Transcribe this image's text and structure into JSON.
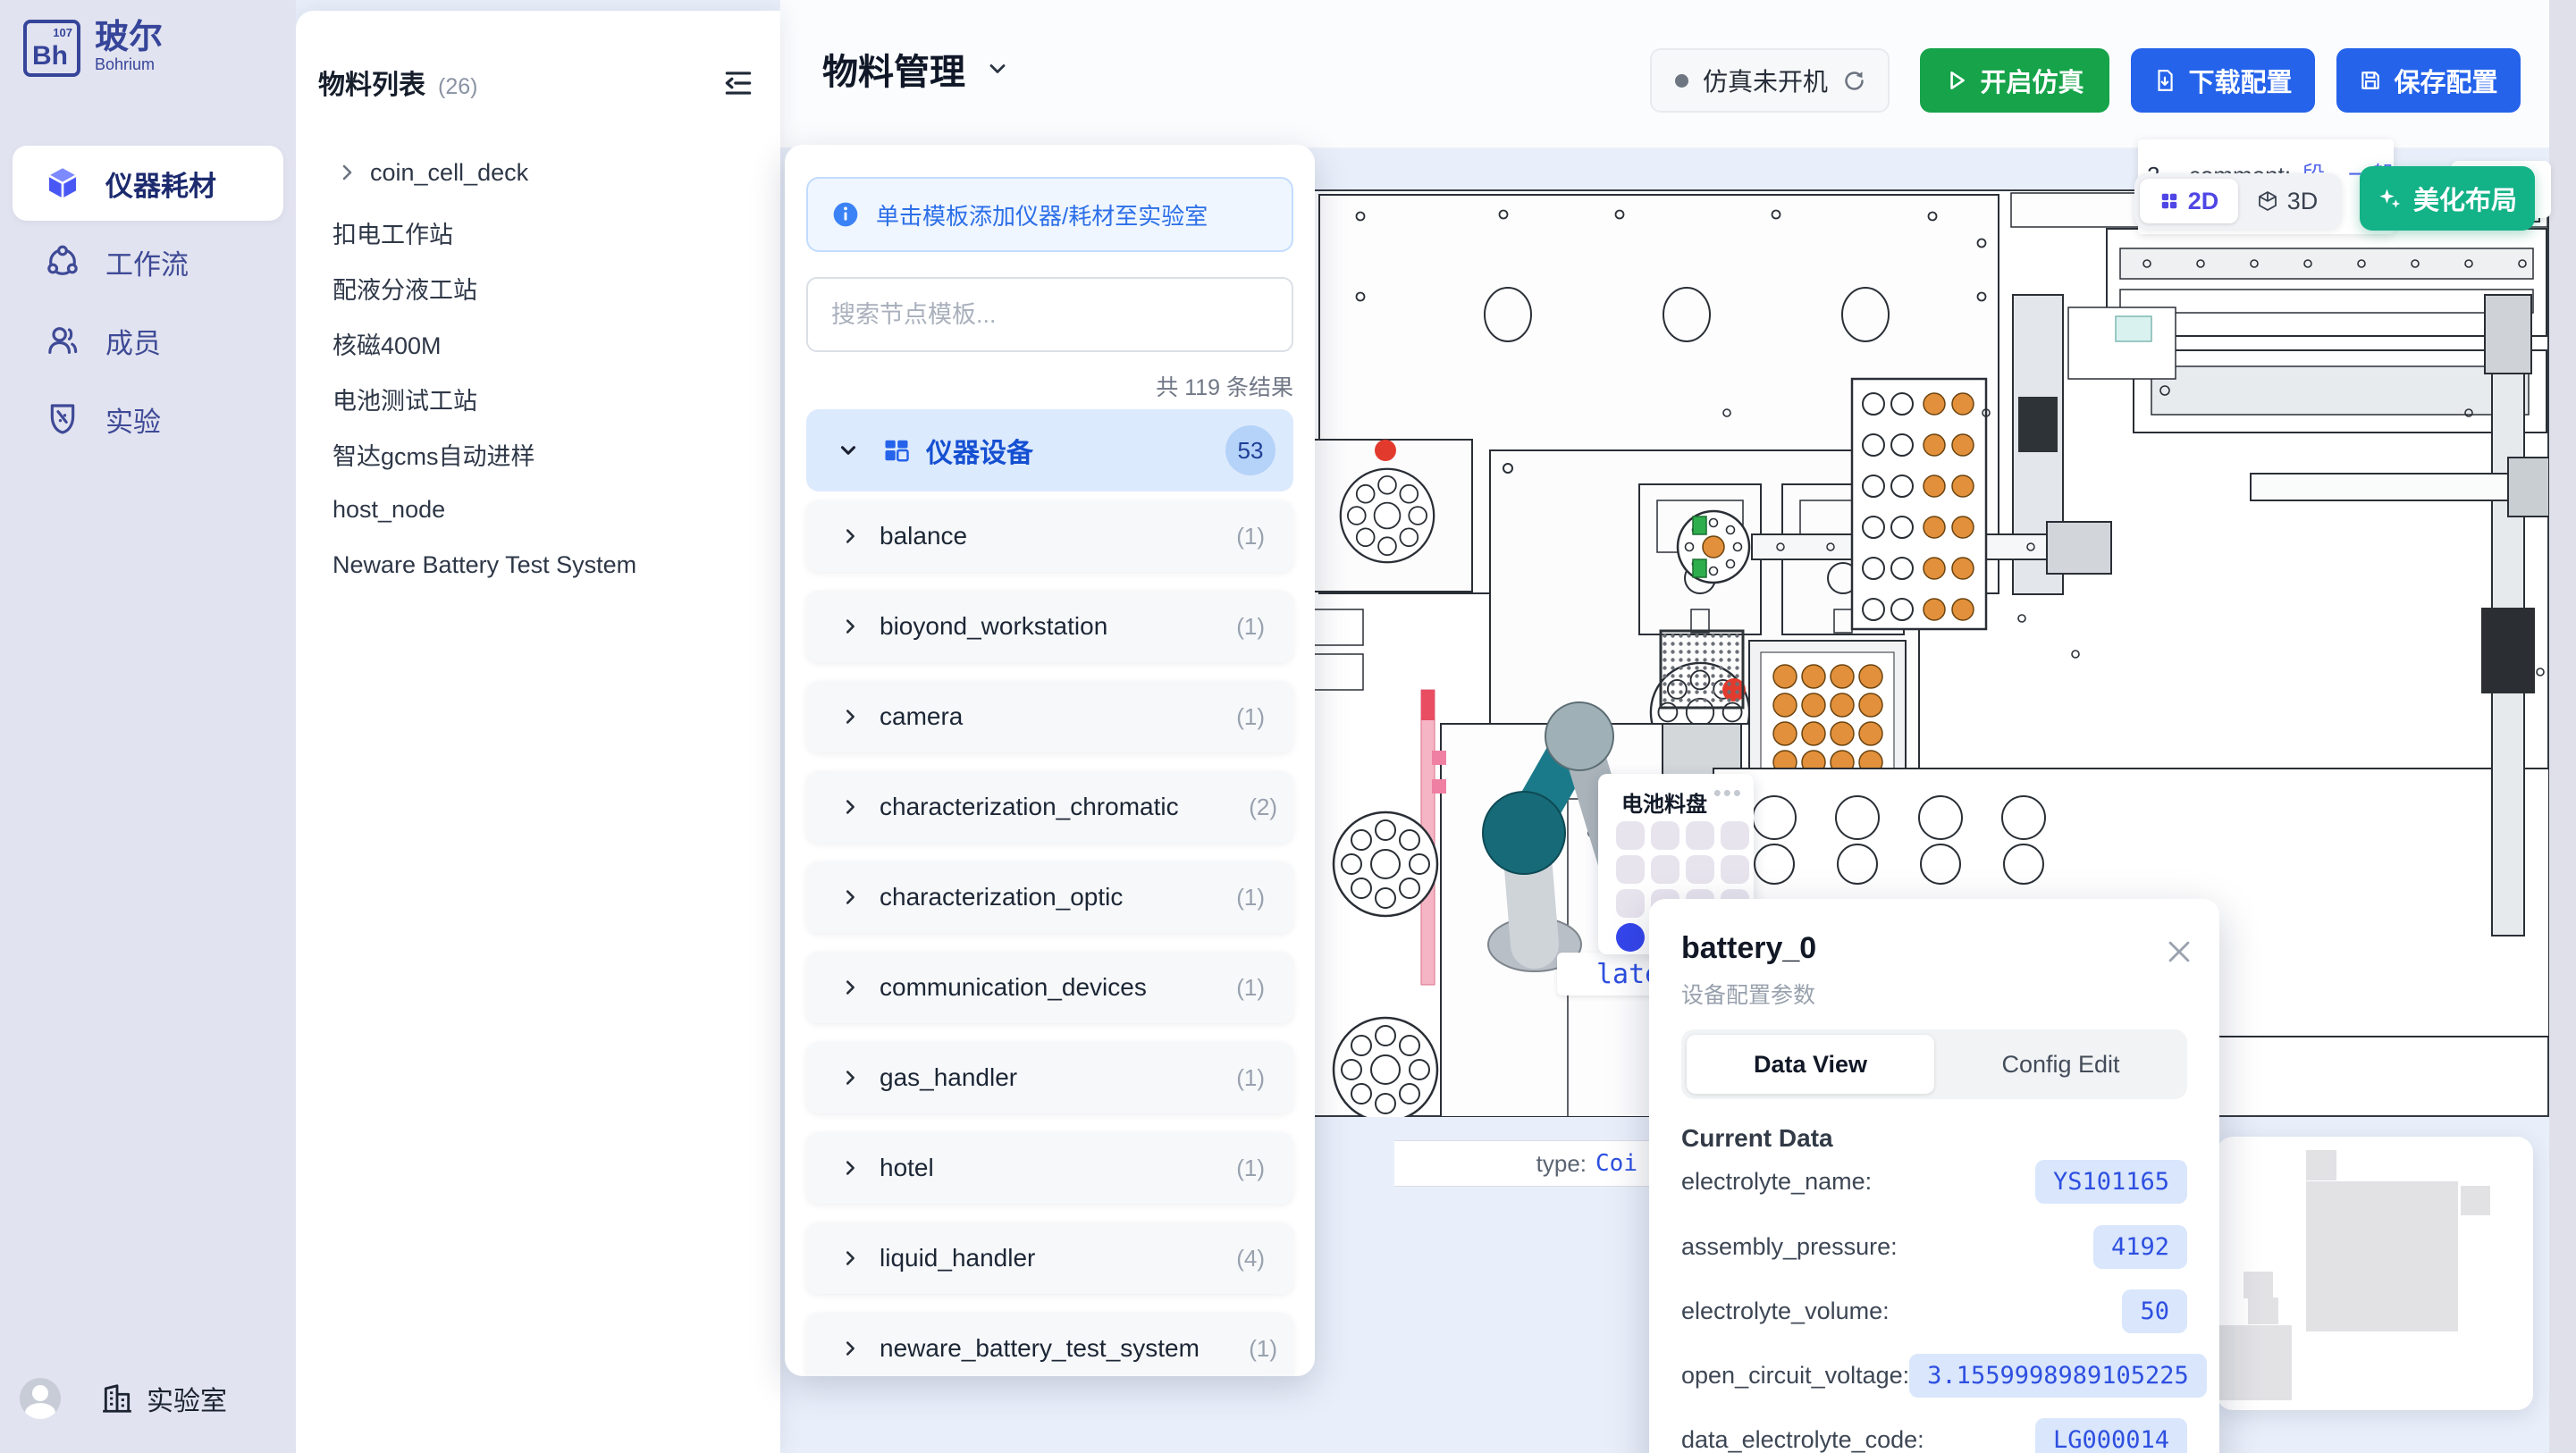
{
  "sidebar": {
    "logo": {
      "abbr": "Bh",
      "number": "107",
      "title": "玻尔",
      "subtitle": "Bohrium"
    },
    "items": [
      {
        "label": "仪器耗材"
      },
      {
        "label": "工作流"
      },
      {
        "label": "成员"
      },
      {
        "label": "实验"
      }
    ],
    "workspace": "实验室"
  },
  "material_panel": {
    "title": "物料列表",
    "count": "(26)",
    "items": [
      "coin_cell_deck",
      "扣电工作站",
      "配液分液工站",
      "核磁400M",
      "电池测试工站",
      "智达gcms自动进样",
      "host_node",
      "Neware Battery Test System"
    ]
  },
  "header": {
    "title": "物料管理",
    "status_label": "仿真未开机",
    "start_button": "开启仿真",
    "download_button": "下载配置",
    "save_button": "保存配置"
  },
  "template_panel": {
    "hint": "单击模板添加仪器/耗材至实验室",
    "search_placeholder": "搜索节点模板...",
    "result_count": "共 119 条结果",
    "category": {
      "label": "仪器设备",
      "badge": "53"
    },
    "items": [
      {
        "label": "balance",
        "count": "(1)"
      },
      {
        "label": "bioyond_workstation",
        "count": "(1)"
      },
      {
        "label": "camera",
        "count": "(1)"
      },
      {
        "label": "characterization_chromatic",
        "count": "(2)"
      },
      {
        "label": "characterization_optic",
        "count": "(1)"
      },
      {
        "label": "communication_devices",
        "count": "(1)"
      },
      {
        "label": "gas_handler",
        "count": "(1)"
      },
      {
        "label": "hotel",
        "count": "(1)"
      },
      {
        "label": "liquid_handler",
        "count": "(4)"
      },
      {
        "label": "neware_battery_test_system",
        "count": "(1)"
      }
    ]
  },
  "canvas": {
    "comment_tooltip": {
      "prefix": "2",
      "label": "_comment:",
      "value": "段，一般为空，stat"
    },
    "view_2d": "2D",
    "view_3d": "3D",
    "beautify_button": "美化布局",
    "partial_text": "esou",
    "tray_title": "电池料盘",
    "plate_partial": "late",
    "type_label": "type:",
    "type_value": "Coi"
  },
  "popup": {
    "title": "battery_0",
    "subtitle": "设备配置参数",
    "tab_data_view": "Data View",
    "tab_config_edit": "Config Edit",
    "section_title": "Current Data",
    "rows": [
      {
        "key": "electrolyte_name:",
        "value": "YS101165"
      },
      {
        "key": "assembly_pressure:",
        "value": "4192"
      },
      {
        "key": "electrolyte_volume:",
        "value": "50"
      },
      {
        "key": "open_circuit_voltage:",
        "value": "3.1559998989105225"
      },
      {
        "key": "data_electrolyte_code:",
        "value": "LG000014"
      }
    ]
  }
}
